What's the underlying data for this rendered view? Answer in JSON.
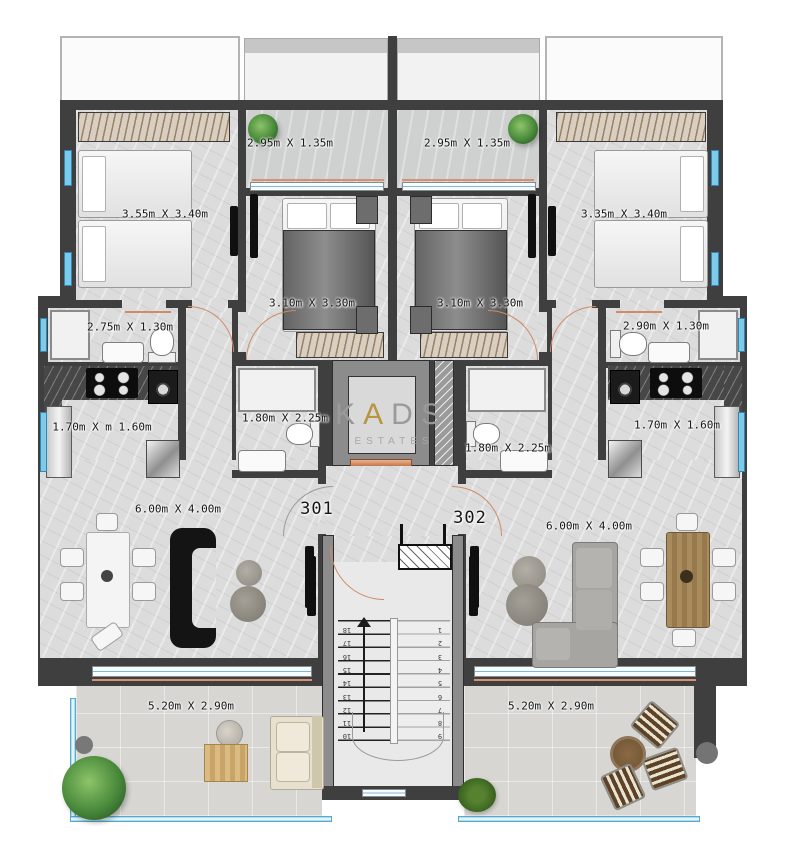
{
  "watermark": {
    "k": "K",
    "a": "A",
    "ds": "DS",
    "subtitle": "ESTATES"
  },
  "units": {
    "left": "301",
    "right": "302"
  },
  "labels": {
    "balcony_left": "2.95m X 1.35m",
    "balcony_right": "2.95m X 1.35m",
    "bedroom_far_left": "3.55m X 3.40m",
    "bedroom_mid_left": "3.10m X 3.30m",
    "bedroom_mid_right": "3.10m X 3.30m",
    "bedroom_far_right": "3.35m X 3.40m",
    "bathroom_left": "2.75m X  1.30m",
    "bathroom_right": "2.90m X 1.30m",
    "kitchen_left": "1.70m X m 1.60m",
    "kitchen_right": "1.70m X 1.60m",
    "bathroom_center_left": "1.80m X 2.25m",
    "bathroom_center_right": "1.80m X 2.25m",
    "living_left": "6.00m X 4.00m",
    "living_right": "6.00m X 4.00m",
    "terrace_left": "5.20m X 2.90m",
    "terrace_right": "5.20m X 2.90m"
  },
  "stairs": {
    "right_flight": [
      "1",
      "2",
      "3",
      "4",
      "5",
      "6",
      "7",
      "8",
      "9"
    ],
    "left_flight": [
      "18",
      "17",
      "16",
      "15",
      "14",
      "13",
      "12",
      "11",
      "10"
    ]
  },
  "colors": {
    "wall": "#3f3f3f",
    "wall_light": "#8c8c8c",
    "floor": "#dcdcdc",
    "terrace": "#d7d6d2",
    "glass": "#7ecbe9",
    "door_accent": "#cf8a66",
    "brand_gold": "#b8963f",
    "watermark_gray": "#9a9a9a"
  }
}
